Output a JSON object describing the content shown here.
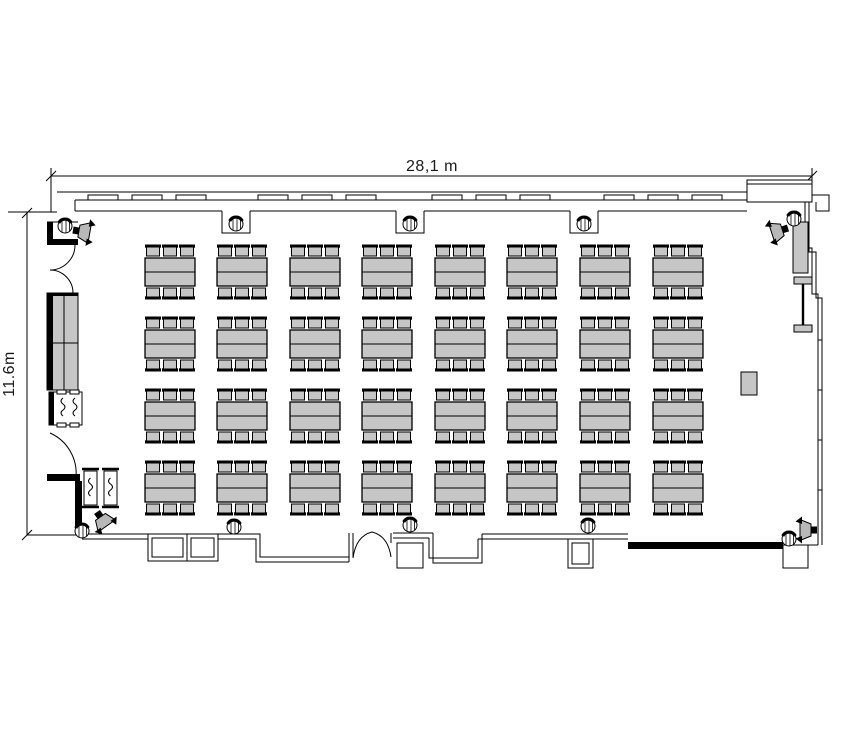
{
  "page": {
    "background": "#ffffff",
    "type": "floor-plan"
  },
  "dimensions": {
    "width_label": "28,1 m",
    "height_label": "11.6m"
  },
  "colors": {
    "furniture_fill": "#c6c6c6",
    "speaker_fill": "#b8b8b8",
    "wall": "#000000",
    "background": "#ffffff"
  },
  "furniture": {
    "table_grid": {
      "rows": 4,
      "cols": 8,
      "chairs_per_side": 3,
      "col_x": [
        145,
        217,
        290,
        362,
        435,
        507,
        580,
        653
      ],
      "row_y": [
        258,
        330,
        402,
        474
      ],
      "table_w": 50,
      "table_h": 28,
      "chair_offsets": [
        1.5,
        18.5,
        35.5
      ],
      "table_count": 32,
      "seat_count": 192
    },
    "columns": [
      [
        236,
        224
      ],
      [
        410,
        224
      ],
      [
        584,
        224
      ],
      [
        65,
        226
      ],
      [
        794,
        219
      ],
      [
        234,
        527
      ],
      [
        410,
        525
      ],
      [
        588,
        526
      ],
      [
        789,
        539
      ],
      [
        82,
        531
      ]
    ],
    "speakers": [
      {
        "x": 73,
        "y": 230,
        "angle": 10
      },
      {
        "x": 788,
        "y": 228,
        "angle": 162
      },
      {
        "x": 97,
        "y": 512,
        "angle": 55
      },
      {
        "x": 817,
        "y": 530,
        "angle": 180
      }
    ],
    "window_sills_x": [
      88,
      132,
      176,
      258,
      302,
      346,
      432,
      476,
      520,
      604,
      648,
      692
    ]
  }
}
